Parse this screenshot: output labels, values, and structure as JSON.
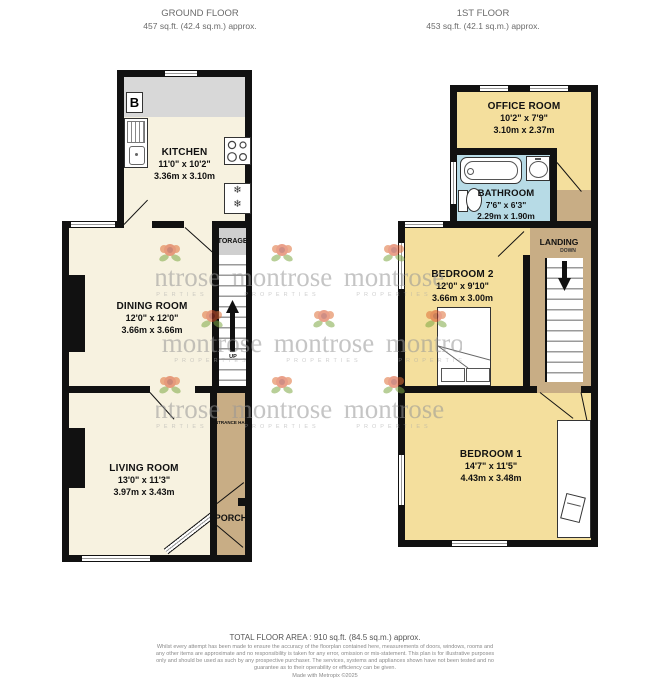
{
  "header": {
    "ground": {
      "title": "GROUND FLOOR",
      "area": "457 sq.ft. (42.4 sq.m.) approx."
    },
    "first": {
      "title": "1ST FLOOR",
      "area": "453 sq.ft. (42.1 sq.m.) approx."
    }
  },
  "rooms": {
    "kitchen": {
      "name": "KITCHEN",
      "imperial": "11'0\" x 10'2\"",
      "metric": "3.36m x 3.10m"
    },
    "dining_room": {
      "name": "DINING ROOM",
      "imperial": "12'0\" x 12'0\"",
      "metric": "3.66m x 3.66m"
    },
    "living_room": {
      "name": "LIVING ROOM",
      "imperial": "13'0\" x 11'3\"",
      "metric": "3.97m x 3.43m"
    },
    "office_room": {
      "name": "OFFICE ROOM",
      "imperial": "10'2\" x 7'9\"",
      "metric": "3.10m x 2.37m"
    },
    "bathroom": {
      "name": "BATHROOM",
      "imperial": "7'6\" x 6'3\"",
      "metric": "2.29m x 1.90m"
    },
    "bedroom2": {
      "name": "BEDROOM 2",
      "imperial": "12'0\" x 9'10\"",
      "metric": "3.66m x 3.00m"
    },
    "bedroom1": {
      "name": "BEDROOM 1",
      "imperial": "14'7\" x 11'5\"",
      "metric": "4.43m x 3.48m"
    }
  },
  "labels": {
    "storage": "STORAGE",
    "up": "UP",
    "down": "DOWN",
    "landing": "LANDING",
    "entrance_hall": "ENTRANCE HALL",
    "porch": "PORCH",
    "boiler": "B",
    "snowflake": "❄"
  },
  "watermark": {
    "brand": "montrose",
    "tagline": "PROPERTIES"
  },
  "footer": {
    "total": "TOTAL FLOOR AREA : 910 sq.ft. (84.5 sq.m.) approx.",
    "disclaimer": "Whilst every attempt has been made to ensure the accuracy of the floorplan contained here, measurements of doors, windows, rooms and any other items are approximate and no responsibility is taken for any error, omission or mis-statement. This plan is for illustrative purposes only and should be used as such by any prospective purchaser. The services, systems and appliances shown have not been tested and no guarantee as to their operability or efficiency can be given.",
    "made_with": "Made with Metropix ©2025"
  },
  "colors": {
    "wall": "#111111",
    "cream": "#F7F2E0",
    "yellow": "#F4DF9D",
    "blue": "#B7DBE6",
    "tan": "#C8AD85",
    "counter": "#D8D8D8"
  }
}
